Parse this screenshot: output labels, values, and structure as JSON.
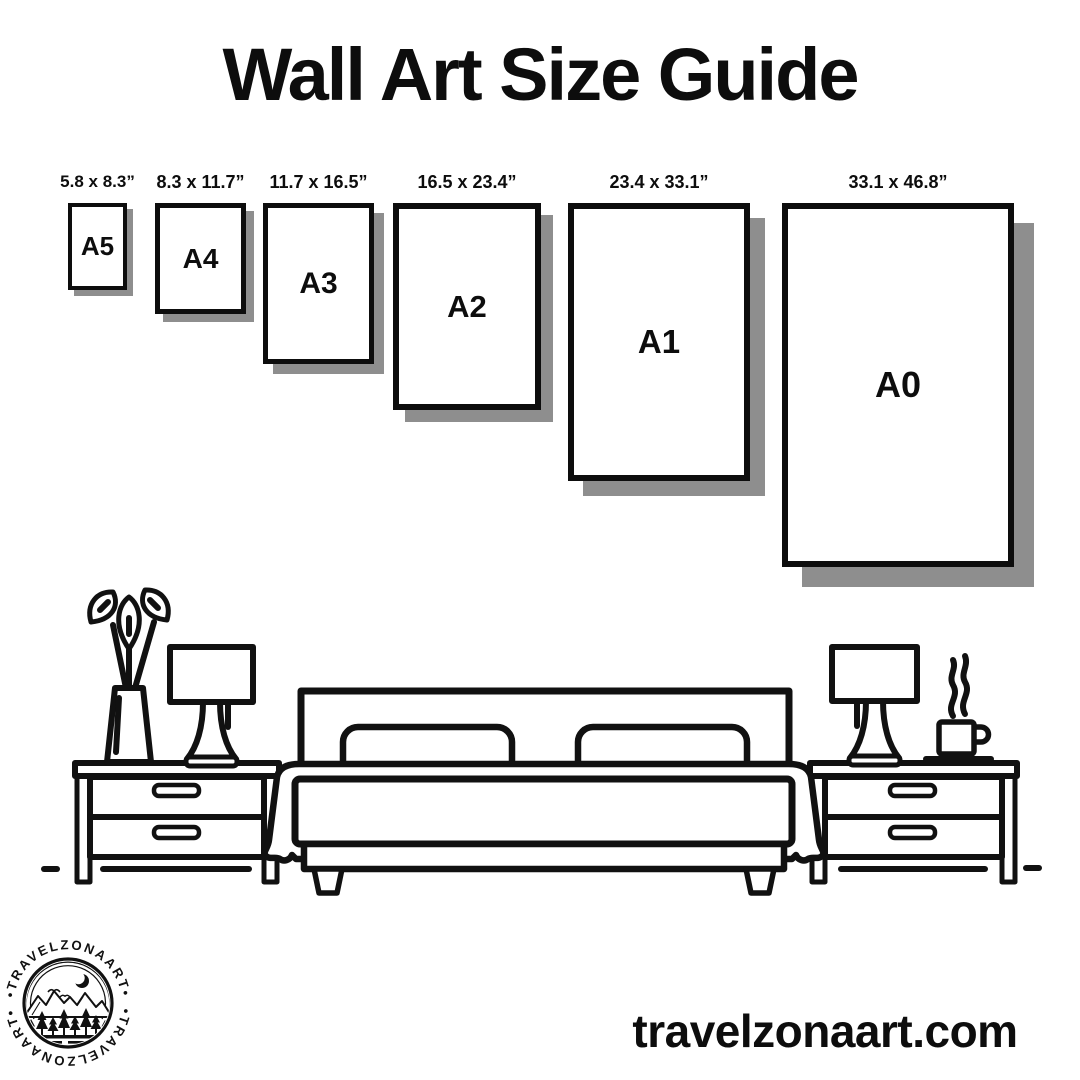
{
  "title": "Wall Art Size Guide",
  "sizes": [
    {
      "code": "A5",
      "dimensions": "5.8 x 8.3”"
    },
    {
      "code": "A4",
      "dimensions": "8.3 x 11.7”"
    },
    {
      "code": "A3",
      "dimensions": "11.7 x 16.5”"
    },
    {
      "code": "A2",
      "dimensions": "16.5 x 23.4”"
    },
    {
      "code": "A1",
      "dimensions": "23.4 x 33.1”"
    },
    {
      "code": "A0",
      "dimensions": "33.1 x 46.8”"
    }
  ],
  "logo": {
    "brand": "TRAVELZONAART",
    "arc_text_top": "•TRAVELZONAART•",
    "arc_text_bottom": "•TRAVELZONAART•"
  },
  "footer": {
    "website": "travelzonaart.com"
  },
  "colors": {
    "background": "#ffffff",
    "ink": "#111111",
    "shadow": "#8e8e8e"
  },
  "illustration": {
    "icons": [
      "flower-vase-icon",
      "table-lamp-icon",
      "nightstand-icon",
      "double-bed-icon",
      "coffee-cup-icon"
    ]
  }
}
